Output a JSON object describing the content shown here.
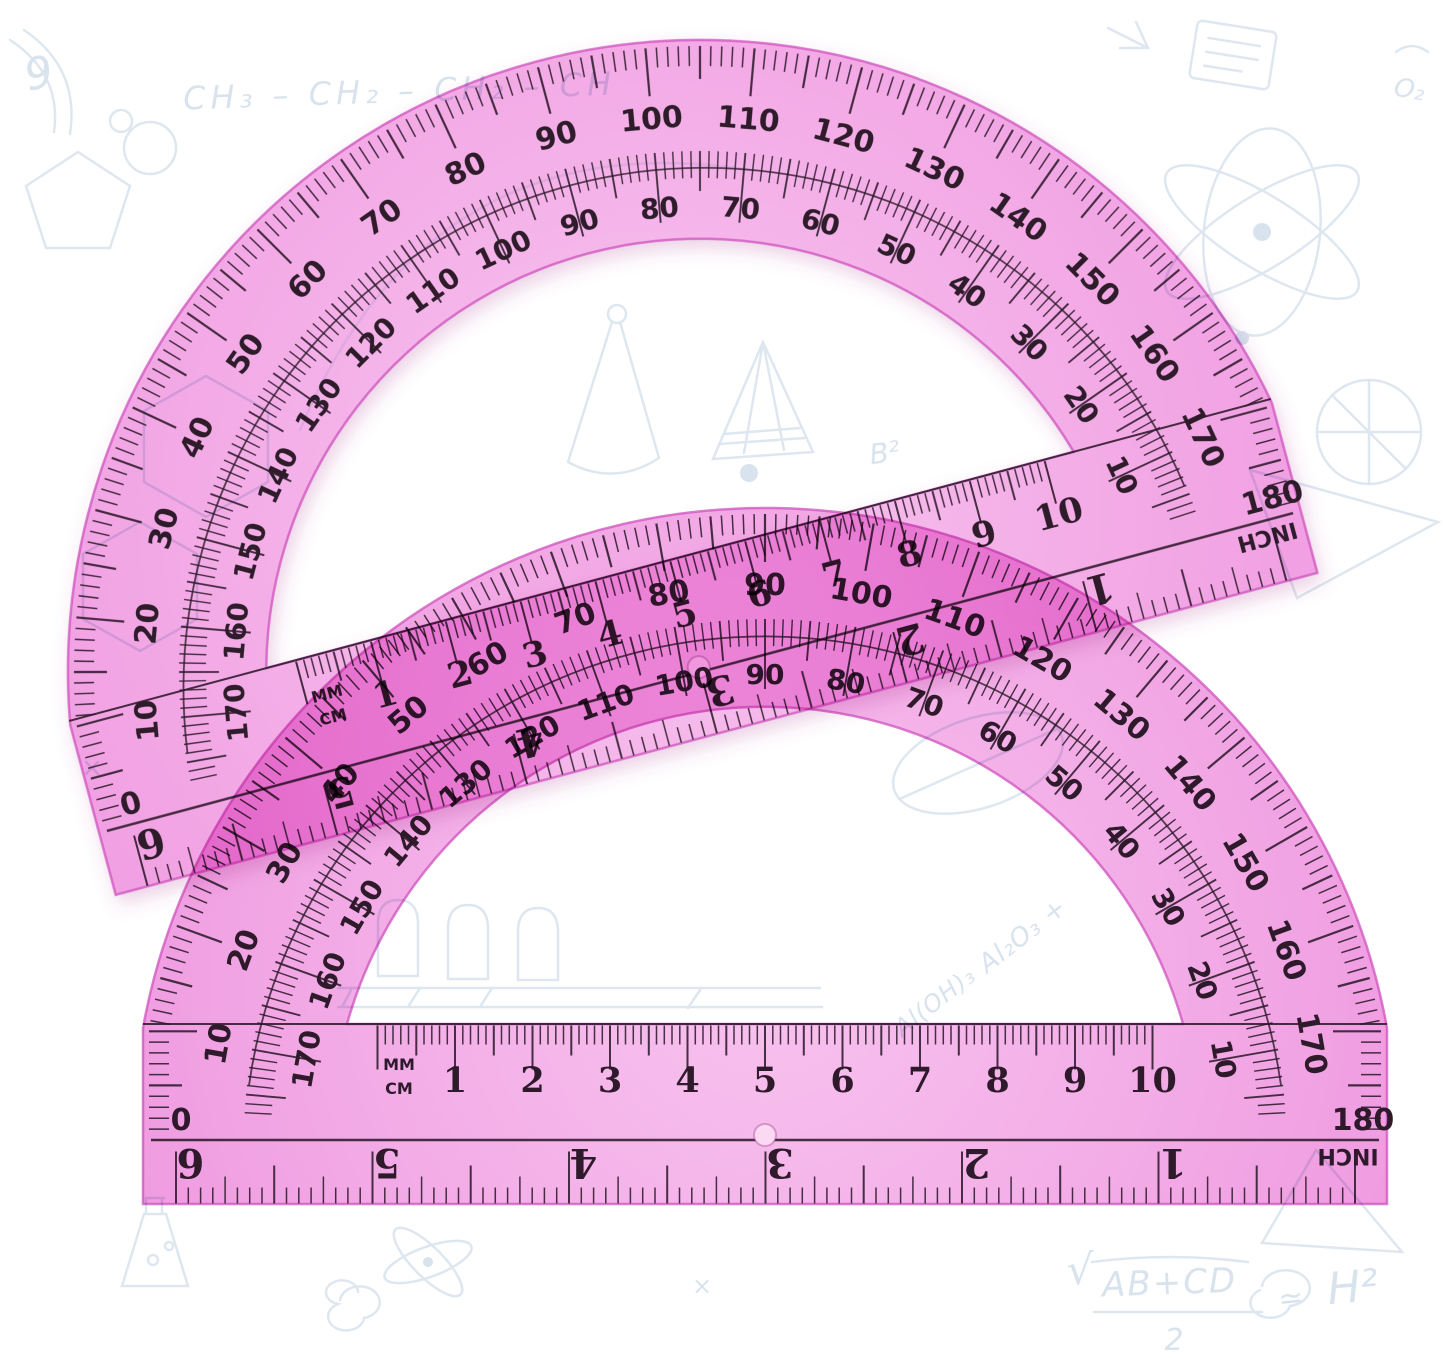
{
  "image": {
    "subject": "Two overlapping translucent pink plastic protractors, 6 inch 180 degree, on a white background with faint science sketch doodles"
  },
  "colors": {
    "background": "#ffffff",
    "plastic_back": "#f2a9e5",
    "plastic_front": "#f3abe6",
    "plastic_highlight": "#f8c3ef",
    "plastic_deep": "#ee92dd",
    "edge": "#cf52bd",
    "ink": "#2e1a2b",
    "rivet": "#fbd9f3",
    "doodle": "#dce5f0"
  },
  "protractor_scale": {
    "outer_degree_labels": [
      10,
      20,
      30,
      40,
      50,
      60,
      70,
      80,
      90,
      100,
      110,
      120,
      130,
      140,
      150,
      160,
      170
    ],
    "inner_degree_labels": [
      10,
      20,
      30,
      40,
      50,
      60,
      70,
      80,
      90,
      100,
      110,
      120,
      130,
      140,
      150,
      160,
      170
    ],
    "baseline_left_label": "0",
    "baseline_right_label": "180",
    "cm_numbers": [
      "1",
      "2",
      "3",
      "4",
      "5",
      "6",
      "7",
      "8",
      "9",
      "10"
    ],
    "inch_numbers": [
      "1",
      "2",
      "3",
      "4",
      "5",
      "6"
    ],
    "unit_labels": {
      "mm": "MM",
      "cm": "CM",
      "inch": "INCH"
    }
  },
  "protractors": [
    {
      "name": "protractor-back",
      "cx": 765,
      "cy": 1140,
      "rotation": 0,
      "shadow": false
    },
    {
      "name": "protractor-front",
      "cx": 700,
      "cy": 672,
      "rotation": -15,
      "shadow": true
    }
  ],
  "doodle_texts": [
    {
      "text": "CH₃ – CH₂ – CH₂ – CH",
      "x": 400,
      "y": 102,
      "size": 32,
      "rot": -2,
      "spacing": 5
    },
    {
      "text": "9",
      "x": 42,
      "y": 88,
      "size": 44,
      "rot": -12,
      "spacing": 0
    },
    {
      "text": "O₂",
      "x": 1408,
      "y": 98,
      "size": 26,
      "rot": 10,
      "spacing": 0
    },
    {
      "text": "B²",
      "x": 886,
      "y": 462,
      "size": 28,
      "rot": -8,
      "spacing": 0
    },
    {
      "text": "Al₂O₃ +",
      "x": 1028,
      "y": 942,
      "size": 26,
      "rot": -38,
      "spacing": 1
    },
    {
      "text": "Al(OH)₃",
      "x": 940,
      "y": 1008,
      "size": 24,
      "rot": -38,
      "spacing": 1
    },
    {
      "text": "√",
      "x": 1080,
      "y": 1284,
      "size": 42,
      "rot": 0,
      "spacing": 0
    },
    {
      "text": "AB+CD",
      "x": 1170,
      "y": 1294,
      "size": 34,
      "rot": -2,
      "spacing": 2
    },
    {
      "text": "2",
      "x": 1174,
      "y": 1350,
      "size": 30,
      "rot": 0,
      "spacing": 0
    },
    {
      "text": "≃",
      "x": 1292,
      "y": 1308,
      "size": 30,
      "rot": -6,
      "spacing": 0
    },
    {
      "text": "H²",
      "x": 1354,
      "y": 1302,
      "size": 44,
      "rot": -5,
      "spacing": 0
    },
    {
      "text": "×",
      "x": 702,
      "y": 1294,
      "size": 24,
      "rot": 0,
      "spacing": 0
    },
    {
      "text": "×",
      "x": 92,
      "y": 776,
      "size": 26,
      "rot": 0,
      "spacing": 0
    }
  ]
}
